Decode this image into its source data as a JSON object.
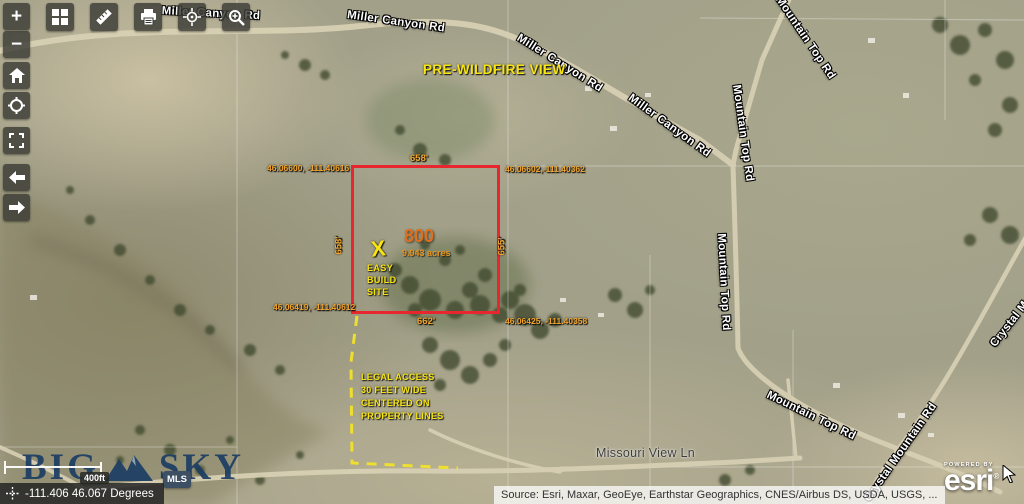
{
  "annotations": {
    "view_label": "PRE-WILDFIRE VIEW",
    "parcel": {
      "number": "800",
      "acreage": "9.943 acres",
      "marker": "X",
      "build_site": [
        "EASY",
        "BUILD",
        "SITE"
      ],
      "corners": {
        "top_left": "46.06600, -111.40616",
        "top_right": "46.06602,-111.40362",
        "bottom_left": "46.06419, -111.40612",
        "bottom_right": "46.06425, -111.40358"
      },
      "sides": {
        "top": "658'",
        "left": "658'",
        "right": "655'",
        "bottom": "662'"
      }
    },
    "legal_access": [
      "LEGAL ACCESS",
      "30 FEET WIDE",
      "CENTERED ON",
      "PROPERTY LINES"
    ],
    "colors": {
      "parcel_outline": "#e8262d",
      "measurement_text": "#f2a42c",
      "parcel_number": "#dd6f1e",
      "note_yellow": "#f7e410"
    }
  },
  "roads": {
    "labels": [
      "Miller Canyon Rd",
      "Miller Canyon Rd",
      "Miller Canyon Rd",
      "Miller Canyon Rd",
      "Mountain Top Rd",
      "Mountain Top Rd",
      "Mountain Top Rd",
      "Mountain Top Rd",
      "Missouri View Ln",
      "Crystal Mountain Rd",
      "Crystal Mountain Rd"
    ]
  },
  "controls": {
    "zoom_in": "+",
    "zoom_out": "−",
    "icons": {
      "home": "home",
      "locate": "crosshair-circle",
      "fullscreen": "expand",
      "back": "arrow-left",
      "forward": "arrow-right",
      "basemap": "grid",
      "measure": "ruler",
      "print": "printer",
      "gps": "crosshair",
      "zoom_tool": "magnifier-plus"
    }
  },
  "scalebar": {
    "label": "400ft"
  },
  "statusbar": {
    "coordinates": "-111.406 46.067 Degrees"
  },
  "branding": {
    "big": "BIG",
    "sky": "SKY",
    "mls": "MLS"
  },
  "attribution": {
    "source": "Source: Esri, Maxar, GeoEye, Earthstar Geographics, CNES/Airbus DS, USDA, USGS, ...",
    "powered_by": "POWERED BY",
    "esri": "esri"
  }
}
